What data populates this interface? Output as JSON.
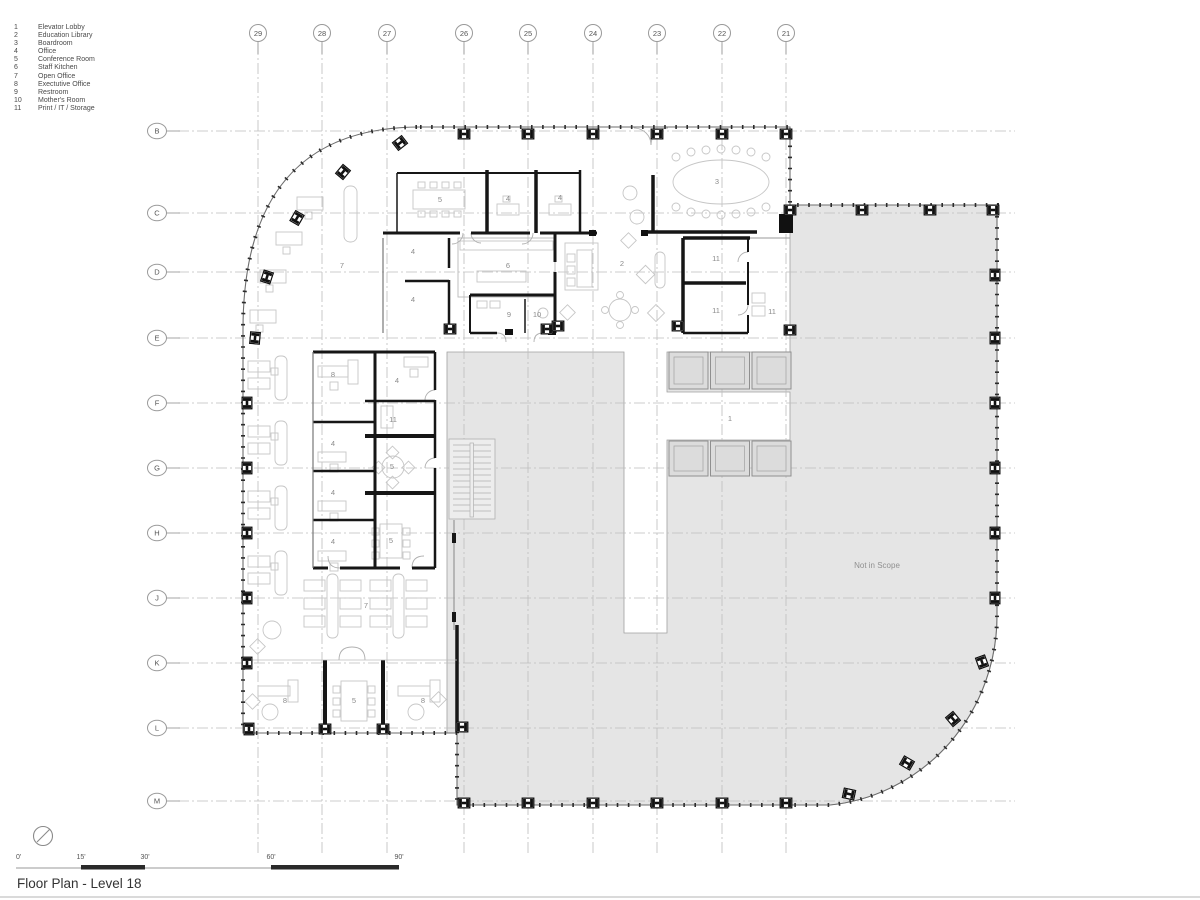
{
  "title": "Floor Plan - Level 18",
  "legend": {
    "items": [
      {
        "num": "1",
        "name": "Elevator Lobby"
      },
      {
        "num": "2",
        "name": "Education Library"
      },
      {
        "num": "3",
        "name": "Boardroom"
      },
      {
        "num": "4",
        "name": "Office"
      },
      {
        "num": "5",
        "name": "Conference Room"
      },
      {
        "num": "6",
        "name": "Staff Kitchen"
      },
      {
        "num": "7",
        "name": "Open Office"
      },
      {
        "num": "8",
        "name": "Exectutive Office"
      },
      {
        "num": "9",
        "name": "Restroom"
      },
      {
        "num": "10",
        "name": "Mother's Room"
      },
      {
        "num": "11",
        "name": "Print / IT / Storage"
      }
    ]
  },
  "grid": {
    "columns": [
      {
        "label": "29",
        "x": 258
      },
      {
        "label": "28",
        "x": 322
      },
      {
        "label": "27",
        "x": 387
      },
      {
        "label": "26",
        "x": 464
      },
      {
        "label": "25",
        "x": 528
      },
      {
        "label": "24",
        "x": 593
      },
      {
        "label": "23",
        "x": 657
      },
      {
        "label": "22",
        "x": 722
      },
      {
        "label": "21",
        "x": 786
      }
    ],
    "rows": [
      {
        "label": "B",
        "y": 131
      },
      {
        "label": "C",
        "y": 213
      },
      {
        "label": "D",
        "y": 272
      },
      {
        "label": "E",
        "y": 338
      },
      {
        "label": "F",
        "y": 403
      },
      {
        "label": "G",
        "y": 468
      },
      {
        "label": "H",
        "y": 533
      },
      {
        "label": "J",
        "y": 598
      },
      {
        "label": "K",
        "y": 663
      },
      {
        "label": "L",
        "y": 728
      },
      {
        "label": "M",
        "y": 801
      }
    ]
  },
  "plan": {
    "not_in_scope": "Not in Scope",
    "not_in_scope_pos": {
      "x": 877,
      "y": 568
    },
    "room_labels": [
      {
        "num": "5",
        "x": 440,
        "y": 202
      },
      {
        "num": "4",
        "x": 508,
        "y": 201
      },
      {
        "num": "4",
        "x": 560,
        "y": 200
      },
      {
        "num": "3",
        "x": 717,
        "y": 184
      },
      {
        "num": "4",
        "x": 413,
        "y": 254
      },
      {
        "num": "6",
        "x": 508,
        "y": 268
      },
      {
        "num": "2",
        "x": 622,
        "y": 266
      },
      {
        "num": "11",
        "x": 716,
        "y": 261
      },
      {
        "num": "4",
        "x": 413,
        "y": 302
      },
      {
        "num": "9",
        "x": 509,
        "y": 317
      },
      {
        "num": "10",
        "x": 537,
        "y": 317
      },
      {
        "num": "11",
        "x": 716,
        "y": 313
      },
      {
        "num": "11",
        "x": 772,
        "y": 314
      },
      {
        "num": "7",
        "x": 342,
        "y": 268
      },
      {
        "num": "8",
        "x": 333,
        "y": 377
      },
      {
        "num": "4",
        "x": 397,
        "y": 383
      },
      {
        "num": "11",
        "x": 393,
        "y": 422
      },
      {
        "num": "4",
        "x": 333,
        "y": 446
      },
      {
        "num": "5",
        "x": 392,
        "y": 469
      },
      {
        "num": "4",
        "x": 333,
        "y": 495
      },
      {
        "num": "4",
        "x": 333,
        "y": 544
      },
      {
        "num": "5",
        "x": 391,
        "y": 543
      },
      {
        "num": "7",
        "x": 366,
        "y": 608
      },
      {
        "num": "8",
        "x": 285,
        "y": 703
      },
      {
        "num": "5",
        "x": 354,
        "y": 703
      },
      {
        "num": "8",
        "x": 423,
        "y": 703
      },
      {
        "num": "1",
        "x": 730,
        "y": 421
      }
    ]
  },
  "scale_bar": {
    "labels": [
      {
        "text": "0'",
        "x": 16
      },
      {
        "text": "15'",
        "x": 81
      },
      {
        "text": "30'",
        "x": 145
      },
      {
        "text": "60'",
        "x": 271
      },
      {
        "text": "90'",
        "x": 399
      }
    ]
  },
  "icons": {
    "north_arrow": "north-arrow-icon",
    "column_marker": "steel-column-icon"
  },
  "colors": {
    "wall": "#161616",
    "outline": "#6e6e6e",
    "grid_line": "#bdbdbd",
    "not_in_scope_fill": "#e5e5e5",
    "furniture": "#c6c6c6",
    "label_text": "#8c8c8c"
  }
}
